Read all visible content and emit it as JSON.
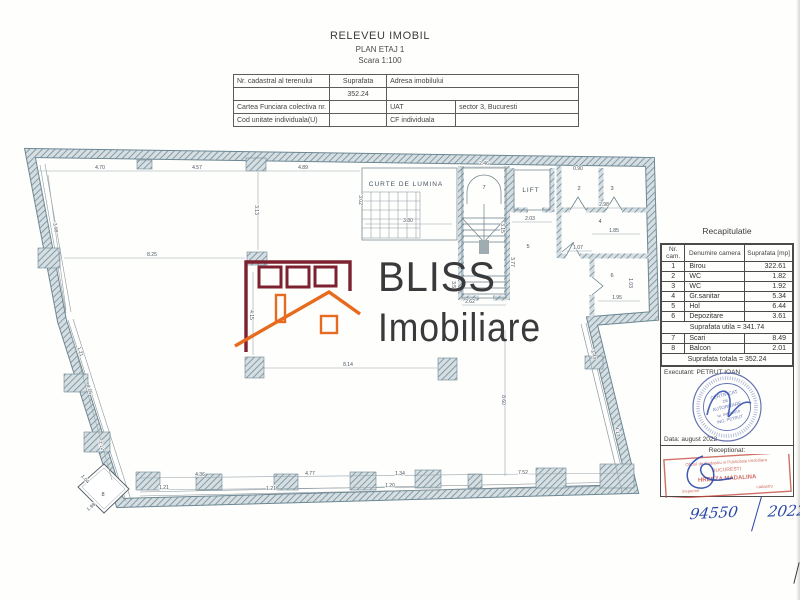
{
  "document": {
    "title": "RELEVEU IMOBIL",
    "subtitle": "PLAN ETAJ 1",
    "scale": "Scara 1:100"
  },
  "header_table": {
    "nr_cadastral_label": "Nr. cadastral al terenului",
    "suprafata_label": "Suprafata",
    "suprafata_value": "352.24",
    "adresa_label": "Adresa imobilului",
    "carte_funciara_label": "Cartea Funciara colectiva nr.",
    "uat_label": "UAT",
    "uat_value": "sector 3, Bucuresti",
    "cod_unitate_label": "Cod unitate individuala(U)",
    "cf_individuala_label": "CF individuala"
  },
  "logo": {
    "name_top": "BLISS",
    "name_bottom": "Imobiliare",
    "maroon": "#7c2130",
    "orange": "#e76b1f",
    "text_color": "#3a3a3c"
  },
  "plan": {
    "curte_label": "CURTE DE LUMINA",
    "lift_label": "LIFT",
    "room_labels": [
      {
        "n": "7",
        "x": 484,
        "y": 189
      },
      {
        "n": "2",
        "x": 579,
        "y": 190
      },
      {
        "n": "3",
        "x": 612,
        "y": 190
      },
      {
        "n": "4",
        "x": 600,
        "y": 223
      },
      {
        "n": "5",
        "x": 528,
        "y": 248
      },
      {
        "n": "6",
        "x": 612,
        "y": 277
      },
      {
        "n": "8",
        "x": 103,
        "y": 496
      }
    ],
    "dimensions": [
      {
        "t": "4.70",
        "x": 100,
        "y": 169
      },
      {
        "t": "4.57",
        "x": 197,
        "y": 169
      },
      {
        "t": "4.89",
        "x": 303,
        "y": 169
      },
      {
        "t": "2.46",
        "x": 484,
        "y": 165
      },
      {
        "t": "3.99",
        "x": 54,
        "y": 228,
        "r": 79
      },
      {
        "t": "4.05",
        "x": 88,
        "y": 390,
        "r": 72
      },
      {
        "t": "1.21",
        "x": 79,
        "y": 352,
        "r": 72
      },
      {
        "t": "2.12",
        "x": 100,
        "y": 446,
        "r": 72
      },
      {
        "t": "8.25",
        "x": 152,
        "y": 256
      },
      {
        "t": "8.14",
        "x": 348,
        "y": 366
      },
      {
        "t": "8.60",
        "x": 502,
        "y": 400,
        "r": 90
      },
      {
        "t": "4.15",
        "x": 250,
        "y": 315,
        "r": 90
      },
      {
        "t": "3.13",
        "x": 255,
        "y": 210,
        "r": 90
      },
      {
        "t": "3.02",
        "x": 359,
        "y": 200,
        "r": 90
      },
      {
        "t": "3.80",
        "x": 408,
        "y": 222
      },
      {
        "t": "3.58",
        "x": 452,
        "y": 286,
        "r": 90
      },
      {
        "t": "3.77",
        "x": 511,
        "y": 262,
        "r": 90
      },
      {
        "t": "3.15",
        "x": 501,
        "y": 228,
        "r": 90
      },
      {
        "t": "2.62",
        "x": 470,
        "y": 303
      },
      {
        "t": "2.03",
        "x": 530,
        "y": 220
      },
      {
        "t": "0.90",
        "x": 578,
        "y": 170
      },
      {
        "t": "2.98",
        "x": 604,
        "y": 206
      },
      {
        "t": "1.85",
        "x": 614,
        "y": 232
      },
      {
        "t": "1.07",
        "x": 578,
        "y": 249
      },
      {
        "t": "1.95",
        "x": 617,
        "y": 299
      },
      {
        "t": "1.03",
        "x": 629,
        "y": 283,
        "r": 90
      },
      {
        "t": "3.43",
        "x": 592,
        "y": 355,
        "r": 77
      },
      {
        "t": "4.13",
        "x": 616,
        "y": 432,
        "r": 77
      },
      {
        "t": "4.36",
        "x": 200,
        "y": 476
      },
      {
        "t": "4.77",
        "x": 310,
        "y": 475
      },
      {
        "t": "1.34",
        "x": 400,
        "y": 475
      },
      {
        "t": "7.52",
        "x": 523,
        "y": 474
      },
      {
        "t": "1.21",
        "x": 164,
        "y": 489
      },
      {
        "t": "1.21",
        "x": 271,
        "y": 490
      },
      {
        "t": "1.20",
        "x": 390,
        "y": 487
      },
      {
        "t": "1.98",
        "x": 92,
        "y": 508,
        "r": -42
      },
      {
        "t": "1.04",
        "x": 84,
        "y": 480,
        "r": 48
      }
    ]
  },
  "recap": {
    "title": "Recapitulatie",
    "columns": [
      "Nr. cam.",
      "Denumire camera",
      "Suprafata [mp]"
    ],
    "rows": [
      [
        "1",
        "Birou",
        "322.61"
      ],
      [
        "2",
        "WC",
        "1.82"
      ],
      [
        "3",
        "WC",
        "1.92"
      ],
      [
        "4",
        "Gr.sanitar",
        "5.34"
      ],
      [
        "5",
        "Hol",
        "6.44"
      ],
      [
        "6",
        "Depozitare",
        "3.61"
      ]
    ],
    "utila": "Suprafata utila = 341.74",
    "rows2": [
      [
        "7",
        "Scari",
        "8.49"
      ],
      [
        "8",
        "Balcon",
        "2.01"
      ]
    ],
    "totala": "Suprafata totala = 352.24",
    "executant": "Executant: PETRUT IOAN",
    "data_line": "Data: august 2022",
    "receptionat": "Receptionat:"
  },
  "stamps": {
    "round": {
      "l1": "CERTIFICAT",
      "l2": "DE",
      "l3": "AUTORIZARE",
      "l4": "Nr. 0450/2010",
      "l5": "ING. PETRUT",
      "color": "#3f51a0"
    },
    "red": {
      "l1": "Oficiul de Cadastru si Publicitate Imobiliara",
      "l2": "BUCURESTI",
      "l3": "HREBZA MADALINA",
      "l4_left": "inspector",
      "l4_right": "cadastru",
      "color": "#c2483c"
    }
  },
  "handwriting": {
    "number": "94550",
    "year": "2022",
    "ink": "#2947a8"
  }
}
